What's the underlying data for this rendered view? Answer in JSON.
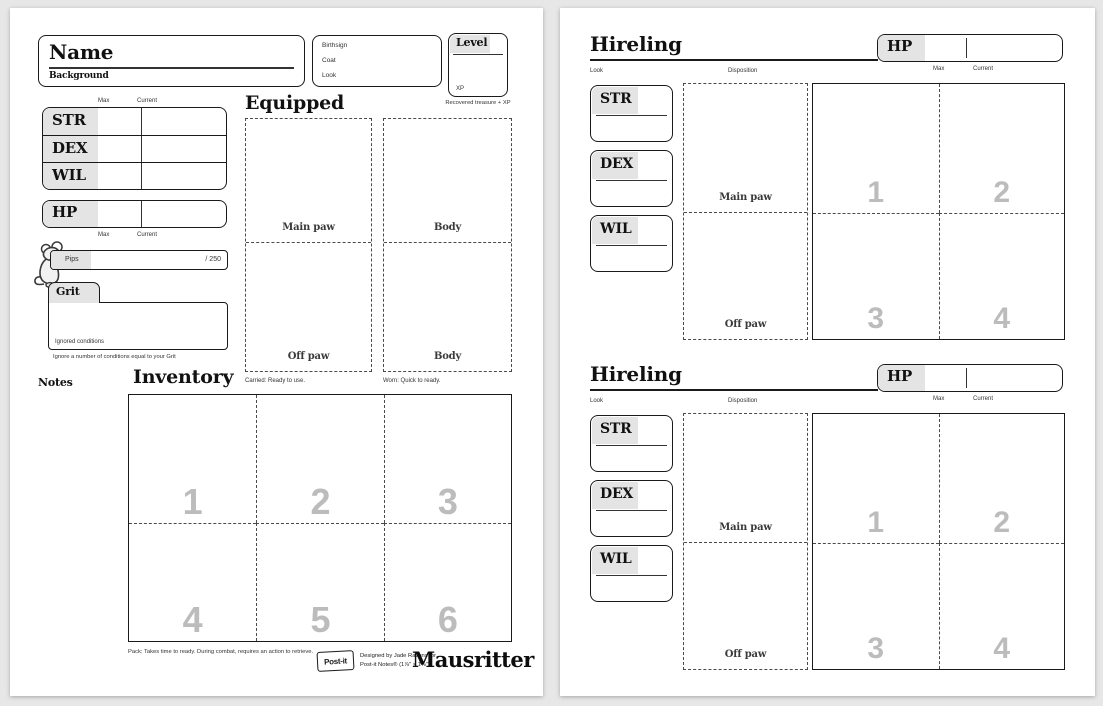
{
  "colors": {
    "desk": "#e7e7e7",
    "paper": "#ffffff",
    "ink": "#1a1a1a",
    "label_bg": "#e4e4e4",
    "slot_number": "#bcbcbc"
  },
  "left_page": {
    "name_box": {
      "title": "Name",
      "background_label": "Background"
    },
    "details_box": {
      "birthsign_label": "Birthsign",
      "coat_label": "Coat",
      "look_label": "Look"
    },
    "level_box": {
      "title": "Level",
      "xp_label": "XP",
      "caption": "Recovered treasure + XP"
    },
    "attributes": {
      "max_label": "Max",
      "current_label": "Current",
      "rows": [
        "STR",
        "DEX",
        "WIL"
      ]
    },
    "hp": {
      "label": "HP",
      "max_label": "Max",
      "current_label": "Current"
    },
    "pips": {
      "label": "Pips",
      "denominator": "/ 250"
    },
    "grit": {
      "label": "Grit",
      "ignored_label": "Ignored conditions",
      "caption": "Ignore a number of conditions equal to your Grit"
    },
    "notes_label": "Notes",
    "equipped": {
      "title": "Equipped",
      "main_paw_label": "Main paw",
      "off_paw_label": "Off paw",
      "body_top_label": "Body",
      "body_bottom_label": "Body",
      "carried_caption": "Carried:  Ready to use.",
      "worn_caption": "Worn:  Quick to ready."
    },
    "inventory": {
      "title": "Inventory",
      "numbers": [
        "1",
        "2",
        "3",
        "4",
        "5",
        "6"
      ],
      "pack_caption": "Pack:  Takes time to ready. During combat, requires an action to retrieve."
    },
    "footer": {
      "postit_badge": "Post-it",
      "credit_line1": "Designed by Jade Ravens for",
      "credit_line2": "Post-it Notes® (1⅞\" × 1⅞\")",
      "brand": "Mausritter"
    }
  },
  "right_page": {
    "hirelings": [
      {
        "title": "Hireling",
        "hp_label": "HP",
        "max_label": "Max",
        "current_label": "Current",
        "look_label": "Look",
        "disposition_label": "Disposition",
        "stats": [
          "STR",
          "DEX",
          "WIL"
        ],
        "main_paw_label": "Main paw",
        "off_paw_label": "Off paw",
        "numbers": [
          "1",
          "2",
          "3",
          "4"
        ]
      },
      {
        "title": "Hireling",
        "hp_label": "HP",
        "max_label": "Max",
        "current_label": "Current",
        "look_label": "Look",
        "disposition_label": "Disposition",
        "stats": [
          "STR",
          "DEX",
          "WIL"
        ],
        "main_paw_label": "Main paw",
        "off_paw_label": "Off paw",
        "numbers": [
          "1",
          "2",
          "3",
          "4"
        ]
      }
    ]
  }
}
